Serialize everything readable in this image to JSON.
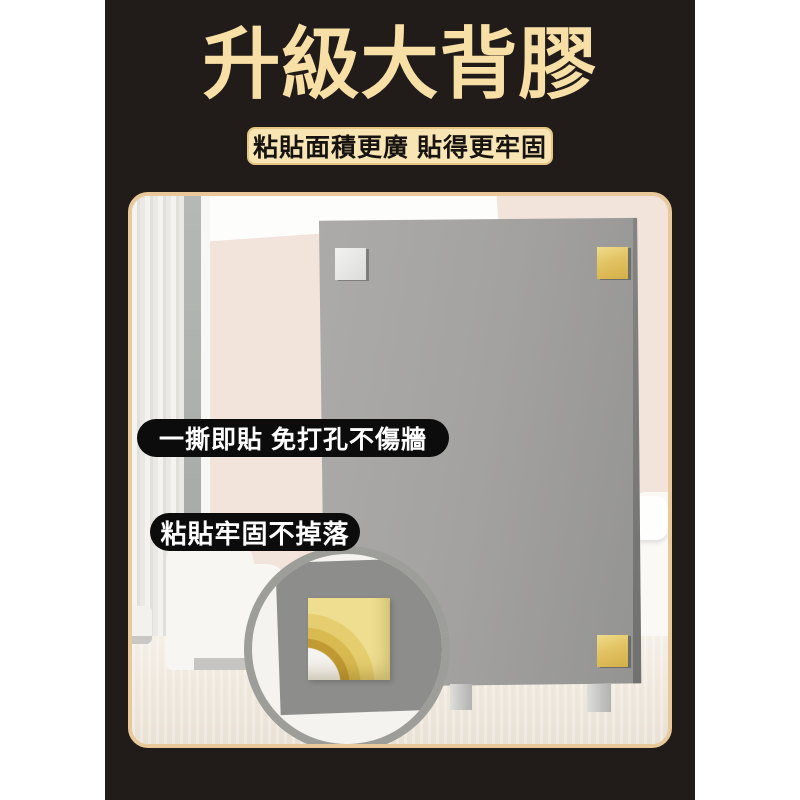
{
  "banner": {
    "title": "升級大背膠",
    "subtitle": "粘貼面積更廣 貼得更牢固",
    "badges": [
      {
        "text": "一撕即貼 免打孔不傷牆"
      },
      {
        "text": "粘貼牢固不掉落"
      }
    ]
  },
  "colors": {
    "page-bg": "#FFFFFF",
    "ink": "#211C1A",
    "cream": "#F7DFA6",
    "cream-bar": "#F9E5B4",
    "bar-border": "#E6C684",
    "bar-text": "#171310",
    "frame": "#E9C89B",
    "wall": "#F2E3DB",
    "ceiling": "#FDFDFC",
    "door-gray": "#ACAEAB",
    "door-trim": "#F7F7F5",
    "board-light": "#ACABA9",
    "board-dark": "#939391",
    "silver-pad": "#EAEAE8",
    "gold-light": "#F0DC8C",
    "gold": "#DFBF58",
    "gold-deep": "#BD9733",
    "carpet": "#EFE9DF",
    "sofa": "#F8F6F2",
    "ring": "#9A9A98",
    "badge-bg": "#0D0C0C",
    "badge-text": "#FFFFFF"
  }
}
